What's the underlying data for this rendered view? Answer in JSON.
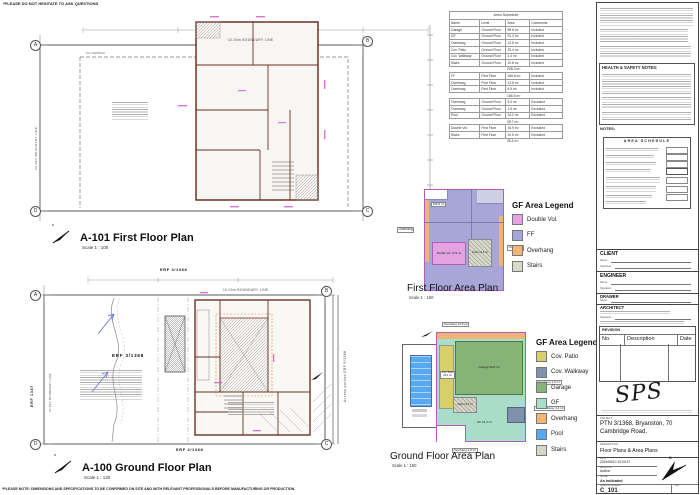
{
  "sheet": {
    "top_note": "*PLEASE DO NOT HESITATE TO ASK QUESTIONS",
    "bottom_note": "*PLEASE NOTE: DIMENSIONS AND SPECIFICATIONS TO BE CONFIRMED ON SITE AND WITH RELEVANT PROFESSIONALS BEFORE MANUFACTURING OR PRODUCTION.",
    "north_letter": "N"
  },
  "plan_first": {
    "title": "A-101 First Floor Plan",
    "scale": "Scale 1 : 100",
    "boundary_top": "10.00m BOUNDARY LINE",
    "boundary_left": "22.35m BOUNDARY LINE",
    "setback": "10m SETBACK",
    "bubbles": {
      "tl": "A",
      "tr": "B",
      "bl": "D",
      "br": "C"
    }
  },
  "plan_ground": {
    "title": "A-100 Ground Floor Plan",
    "scale": "Scale 1 : 130",
    "boundary_top": "10.00m BOUNDARY LINE",
    "boundary_left": "22.35m BOUNDARY LINE",
    "erf_site": "ERF 3/1368",
    "erf_top": "ERF 4/1368",
    "erf_left": "ERF 1347",
    "erf_bottom": "ERF 2/1368",
    "erf_access": "Access portion ERF 5/1368",
    "bubbles": {
      "tl": "A",
      "tr": "B",
      "bl": "D",
      "br": "C"
    }
  },
  "schedule": {
    "title": "Area Schedule",
    "headers": [
      "Name",
      "Level",
      "Area",
      "Comments"
    ],
    "groups": [
      {
        "rows": [
          {
            "name": "Garage",
            "level": "Ground Floor",
            "area": "59.8 m²",
            "comments": "Included"
          },
          {
            "name": "GF",
            "level": "Ground Floor",
            "area": "91.3 m²",
            "comments": "Included"
          },
          {
            "name": "Overhang",
            "level": "Ground Floor",
            "area": "12.8 m²",
            "comments": "Included"
          },
          {
            "name": "Cov. Patio",
            "level": "Ground Floor",
            "area": "29.4 m²",
            "comments": "Included"
          },
          {
            "name": "Cov. Walkway",
            "level": "Ground Floor",
            "area": "4.4 m²",
            "comments": "Included"
          },
          {
            "name": "Stairs",
            "level": "Ground Floor",
            "area": "10.6 m²",
            "comments": "Included"
          }
        ],
        "subtotal": "208.3 m²"
      },
      {
        "rows": [
          {
            "name": "FF",
            "level": "First Floor",
            "area": "166.8 m²",
            "comments": "Included"
          },
          {
            "name": "Overhang",
            "level": "First Floor",
            "area": "12.8 m²",
            "comments": "Included"
          },
          {
            "name": "Overhang",
            "level": "First Floor",
            "area": "6.9 m²",
            "comments": "Included"
          }
        ],
        "subtotal": "186.5 m²"
      },
      {
        "rows": [
          {
            "name": "Overhang",
            "level": "Ground Floor",
            "area": "3.0 m²",
            "comments": "Excluded"
          },
          {
            "name": "Overhang",
            "level": "Ground Floor",
            "area": "1.5 m²",
            "comments": "Excluded"
          },
          {
            "name": "Pool",
            "level": "Ground Floor",
            "area": "24.2 m²",
            "comments": "Excluded"
          }
        ],
        "subtotal": "28.7 m²"
      },
      {
        "rows": [
          {
            "name": "Double Vol.",
            "level": "First Floor",
            "area": "15.9 m²",
            "comments": "Excluded"
          },
          {
            "name": "Stairs",
            "level": "First Floor",
            "area": "10.5 m²",
            "comments": "Excluded"
          }
        ],
        "subtotal": "26.4 m²"
      }
    ]
  },
  "ff_area_plan": {
    "title": "First Floor Area Plan",
    "scale": "Scale 1 : 150",
    "legend_title": "GF Area Legend",
    "legend": [
      {
        "label": "Double Vol.",
        "color": "#e2a3e0"
      },
      {
        "label": "FF",
        "color": "#a6a6d8"
      },
      {
        "label": "Overhang",
        "color": "#f2b377"
      },
      {
        "label": "Stairs",
        "color": "#d8dbc9"
      }
    ],
    "labels": {
      "area": "166.8 m²",
      "double_vol": "Double Vol. 15.9 m²",
      "stairs": "Stairs 10.5 m²",
      "overhang_left": "Overhang",
      "overhang_right": "Overhang"
    }
  },
  "gf_area_plan": {
    "title": "Ground Floor Area Plan",
    "scale": "Scale 1 : 150",
    "legend_title": "GF Area Legend",
    "legend": [
      {
        "label": "Cov. Patio",
        "color": "#d9cf6a"
      },
      {
        "label": "Cov. Walkway",
        "color": "#7e93ab"
      },
      {
        "label": "Garage",
        "color": "#86b377"
      },
      {
        "label": "GF",
        "color": "#aadcca"
      },
      {
        "label": "Overhang",
        "color": "#f2b377"
      },
      {
        "label": "Pool",
        "color": "#58a9f1"
      },
      {
        "label": "Stairs",
        "color": "#d6d6c6"
      }
    ],
    "labels": {
      "overhang_top": "Overhang 12.8 m²",
      "cov_patio": "Cov. Patio 29.4 m²",
      "garage": "Garage 59.8 m²",
      "gf": "GF 91.3 m²",
      "stairs": "Stairs 10.6 m²",
      "overhang_right": "Overhang 1.5 m²",
      "cov_walkway": "Cov. Walkway 4.4 m²",
      "overhang_bottom": "Overhang 3.0 m²"
    }
  },
  "titleblock": {
    "hs_title": "HEALTH & SAFETY NOTES:",
    "notes_label": "NOTES:",
    "summary_title": "AREA SCHEDULE",
    "client_label": "CLIENT",
    "engineer_label": "ENGINEER",
    "drawer_label": "DRAWER",
    "architect_label": "ARCHITECT",
    "name_label": "Name:",
    "signature_label": "Signature:",
    "revision_label": "REVISION",
    "rev_headers": [
      "No.",
      "Description",
      "Date"
    ],
    "logo_text": "SPS",
    "project_label": "PROJECT",
    "project": "PTN 3/1368, Bryanston, 70 Cambridge Road.",
    "description_label": "DESCRIPTION",
    "description": "Floor Plans & Area Plans",
    "date_label": "DATE",
    "date": "2024/06/10 10:00:47",
    "drawnby_label": "DRAWN BY",
    "drawnby": "Author",
    "scale_label": "SCALE",
    "scale": "As indicated",
    "dwgno_label": "DRAWING NUMBER",
    "dwgno": "C_101",
    "rev_label": "REV"
  }
}
